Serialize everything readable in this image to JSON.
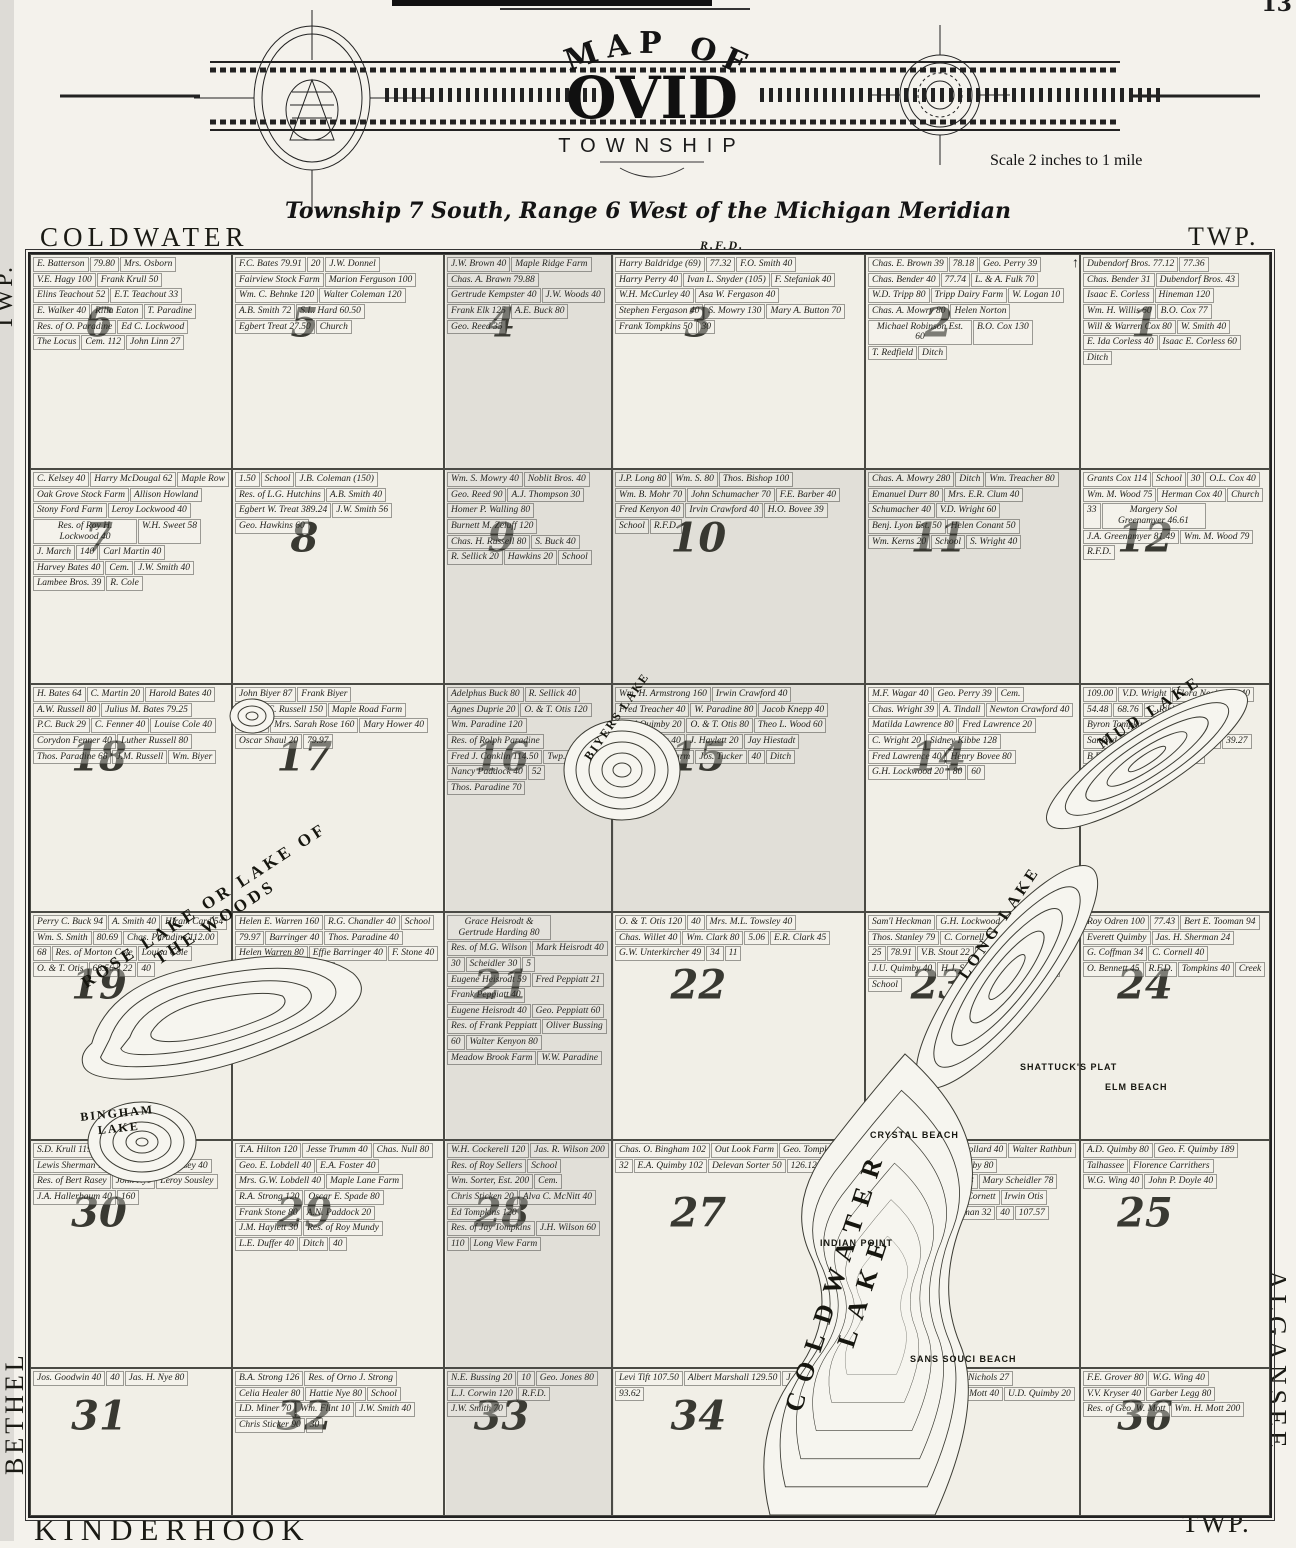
{
  "page": {
    "number": "13"
  },
  "header": {
    "map_of": "MAP OF",
    "name": "OVID",
    "township": "TOWNSHIP",
    "scale": "Scale 2 inches to 1 mile",
    "subtitle": "Township 7 South, Range 6 West of the Michigan Meridian"
  },
  "borders": {
    "top_left": "COLDWATER",
    "top_center": "R.F.D.",
    "top_right": "TWP.",
    "left_top": "TWP.",
    "left_bottom": "BETHEL",
    "bottom_left": "KINDERHOOK",
    "bottom_right": "TWP.",
    "right_top": "TWP.",
    "right_bottom": "ALGANSEE",
    "north_arrow": "↑"
  },
  "map": {
    "lakes": [
      "BIYERS LAKE",
      "MUD LAKE",
      "ROSE LAKE OR LAKE OF THE WOODS",
      "BINGHAM LAKE",
      "LONG LAKE",
      "COLDWATER LAKE"
    ],
    "features": [
      "SHATTUCK'S PLAT",
      "ELM BEACH",
      "CRYSTAL BEACH",
      "INDIAN POINT",
      "SANS SOUCI BEACH"
    ],
    "sections": [
      {
        "number": "6",
        "parcels": [
          "E. Batterson",
          "79.80",
          "Mrs. Osborn",
          "V.E. Hagy 100",
          "Frank Krull 50",
          "Elins Teachout 52",
          "E.T. Teachout 33",
          "E. Walker 40",
          "Rilla Eaton",
          "T. Paradine",
          "Res. of O. Paradine",
          "Ed C. Lockwood",
          "The Locus",
          "Cem. 112",
          "John Linn 27"
        ]
      },
      {
        "number": "5",
        "parcels": [
          "F.C. Bates 79.91",
          "20",
          "J.W. Donnel",
          "Fairview Stock Farm",
          "Marion Ferguson 100",
          "Wm. C. Behnke 120",
          "Walter Coleman 120",
          "A.B. Smith 72",
          "S.L. Hard 60.50",
          "Egbert Treat 27.50",
          "Church"
        ]
      },
      {
        "number": "4",
        "parcels": [
          "J.W. Brown 40",
          "Maple Ridge Farm",
          "Chas. A. Brawn 79.88",
          "Gertrude Kempster 40",
          "J.W. Woods 40",
          "Frank Elk 125",
          "A.E. Buck 80",
          "Geo. Reed 35"
        ]
      },
      {
        "number": "3",
        "parcels": [
          "Harry Baldridge (69)",
          "77.32",
          "F.O. Smith 40",
          "Harry Perry 40",
          "Ivan L. Snyder (105)",
          "F. Stefaniak 40",
          "W.H. McCurley 40",
          "Asa W. Fergason 40",
          "Stephen Fergason 40",
          "S. Mowry 130",
          "Mary A. Button 70",
          "Frank Tompkins 50",
          "30"
        ]
      },
      {
        "number": "2",
        "parcels": [
          "Chas. E. Brown 39",
          "78.18",
          "Geo. Perry 39",
          "Chas. Bender 40",
          "77.74",
          "L. & A. Fulk 70",
          "W.D. Tripp 80",
          "Tripp Dairy Farm",
          "W. Logan 10",
          "Chas. A. Mowry 80",
          "Helen Norton",
          "Michael Robinson Est. 60",
          "B.O. Cox 130",
          "T. Redfield",
          "Ditch"
        ]
      },
      {
        "number": "1",
        "parcels": [
          "Dubendorf Bros. 77.12",
          "77.36",
          "Chas. Bender 31",
          "Dubendorf Bros. 43",
          "Isaac E. Corless",
          "Hineman 120",
          "Wm. H. Willis 60",
          "B.O. Cox 77",
          "Will & Warren Cox 80",
          "W. Smith 40",
          "E. Ida Corless 40",
          "Isaac E. Corless 60",
          "Ditch"
        ]
      },
      {
        "number": "7",
        "parcels": [
          "C. Kelsey 40",
          "Harry McDougal 62",
          "Maple Row",
          "Oak Grove Stock Farm",
          "Allison Howland",
          "Stony Ford Farm",
          "Leroy Lockwood 40",
          "Res. of Roy H. Lockwood 40",
          "W.H. Sweet 58",
          "J. March",
          "140",
          "Carl Martin 40",
          "Harvey Bates 40",
          "Cem.",
          "J.W. Smith 40",
          "Lambee Bros. 39",
          "R. Cole"
        ]
      },
      {
        "number": "8",
        "parcels": [
          "1.50",
          "School",
          "J.B. Coleman (150)",
          "Res. of L.G. Hutchins",
          "A.B. Smith 40",
          "Egbert W. Treat 389.24",
          "J.W. Smith 56",
          "Geo. Hawkins 60"
        ]
      },
      {
        "number": "9",
        "parcels": [
          "Wm. S. Mowry 40",
          "Noblit Bros. 40",
          "Geo. Reed 90",
          "A.J. Thompson 30",
          "Homer P. Walling 80",
          "Burnett M. Zeluff 120",
          "Chas. H. Russell 80",
          "S. Buck 40",
          "R. Sellick 20",
          "Hawkins 20",
          "School"
        ]
      },
      {
        "number": "10",
        "shaded": true,
        "parcels": [
          "J.P. Long 80",
          "Wm. S. 80",
          "Thos. Bishop 100",
          "Wm. B. Mohr 70",
          "John Schumacher 70",
          "F.E. Barber 40",
          "Fred Kenyon 40",
          "Irvin Crawford 40",
          "H.O. Bovee 39",
          "School",
          "R.F.D."
        ]
      },
      {
        "number": "11",
        "shaded": true,
        "parcels": [
          "Chas. A. Mowry 280",
          "Ditch",
          "Wm. Treacher 80",
          "Emanuel Durr 80",
          "Mrs. E.R. Clum 40",
          "Schumacher 40",
          "V.D. Wright 60",
          "Benj. Lyon Est. 50",
          "Helen Conant 50",
          "Wm. Kerns 20",
          "School",
          "S. Wright 40"
        ]
      },
      {
        "number": "12",
        "parcels": [
          "Grants Cox 114",
          "School",
          "30",
          "O.L. Cox 40",
          "Wm. M. Wood 75",
          "Herman Cox 40",
          "Church",
          "33",
          "Margery Sol Greenamyer 46.61",
          "J.A. Greenamyer 81.49",
          "Wm. M. Wood 79",
          "R.F.D."
        ]
      },
      {
        "number": "18",
        "parcels": [
          "H. Bates 64",
          "C. Martin 20",
          "Harold Bates 40",
          "A.W. Russell 80",
          "Julius M. Bates 79.25",
          "P.C. Buck 29",
          "C. Fenner 40",
          "Louise Cole 40",
          "Corydon Fenner 40",
          "Luther Russell 80",
          "Thos. Paradine 68",
          "J.M. Russell",
          "Wm. Biyer"
        ]
      },
      {
        "number": "17",
        "parcels": [
          "John Biyer 87",
          "Frank Biyer",
          "Nelson C. Russell 150",
          "Maple Road Farm",
          "136.67",
          "Mrs. Sarah Rose 160",
          "Mary Hower 40",
          "Oscar Shaul 20",
          "79.97"
        ]
      },
      {
        "number": "16",
        "parcels": [
          "Adelphus Buck 80",
          "R. Sellick 40",
          "Agnes Duprie 20",
          "O. & T. Otis 120",
          "Wm. Paradine 120",
          "Res. of Rolph Paradine",
          "Fred J. Conklin 114.50",
          "Twp. Hall",
          "Nancy Paddock 40",
          "52",
          "Thos. Paradine 70"
        ]
      },
      {
        "number": "15",
        "shaded": true,
        "parcels": [
          "Wm. H. Armstrong 160",
          "Irwin Crawford 40",
          "Fred Treacher 40",
          "W. Paradine 80",
          "Jacob Knepp 40",
          "Fred Quimby 20",
          "O. & T. Otis 80",
          "Theo L. Wood 60",
          "Emma Noyes 40",
          "J. Haylett 20",
          "Jay Hiestadt",
          "Maple Knoll Farm",
          "Jos. Tucker",
          "40",
          "Ditch"
        ]
      },
      {
        "number": "14",
        "parcels": [
          "M.F. Wagar 40",
          "Geo. Perry 39",
          "Cem.",
          "Chas. Wright 39",
          "A. Tindall",
          "Newton Crawford 40",
          "Matilda Lawrence 80",
          "Fred Lawrence 20",
          "C. Wright 20",
          "Sidney Kibbe 128",
          "Fred Lawrence 40",
          "Henry Bovee 80",
          "G.H. Lockwood 20",
          "80",
          "60"
        ]
      },
      {
        "number": "13",
        "parcels": [
          "109.00",
          "V.D. Wright",
          "Flora Neairpass 40",
          "54.48",
          "68.76",
          "C. Ribbeck 109",
          "Byron Tompkins 40",
          "A. Tindall 70",
          "Sanford Tompkins 40",
          "M. Tarr 40",
          "39.27",
          "B.E. Tooman 40",
          "Waldron 10",
          "Addison Tompkins"
        ]
      },
      {
        "number": "19",
        "parcels": [
          "Perry C. Buck 94",
          "A. Smith 40",
          "Hiram Card 54",
          "Wm. S. Smith",
          "80.69",
          "Chas. Paradine 112.00",
          "68",
          "Res. of Morton Cole",
          "Louisa Cole",
          "O. & T. Otis",
          "68.56",
          "22",
          "40"
        ]
      },
      {
        "number": "20",
        "parcels": [
          "Helen E. Warren 160",
          "R.G. Chandler 40",
          "School",
          "79.97",
          "Barringer 40",
          "Thos. Paradine 40",
          "Helen Warren 80",
          "Effie Barringer 40",
          "F. Stone 40",
          "L.E. Duffer 80",
          "40",
          "80"
        ]
      },
      {
        "number": "21",
        "parcels": [
          "Grace Heisrodt & Gertrude Harding 80",
          "Res. of M.G. Wilson",
          "Mark Heisrodt 40",
          "30",
          "Scheidler 30",
          "5",
          "Eugene Heisrodt 59",
          "Fred Peppiatt 21",
          "Frank Peppiatt 40",
          "Eugene Heisrodt 40",
          "Geo. Peppiatt 60",
          "Res. of Frank Peppiatt",
          "Oliver Bussing",
          "60",
          "Walter Kenyon 80",
          "Meadow Brook Farm",
          "W.W. Paradine"
        ]
      },
      {
        "number": "22",
        "parcels": [
          "O. & T. Otis 120",
          "40",
          "Mrs. M.L. Towsley 40",
          "Chas. Willet 40",
          "Wm. Clark 80",
          "5.06",
          "E.R. Clark 45",
          "G.W. Unterkircher 49",
          "34",
          "11"
        ]
      },
      {
        "number": "23",
        "parcels": [
          "Sam'l Heckman",
          "G.H. Lockwood 16",
          "97.86",
          "Thos. Stanley 79",
          "C. Cornell 16",
          "F.G. Pond 50",
          "25",
          "78.91",
          "V.B. Stout 22",
          "Jud. Quimby",
          "J.U. Quimby 40",
          "H.J. Sorter 40",
          "Locas Hill 37",
          "School"
        ]
      },
      {
        "number": "24",
        "parcels": [
          "Roy Odren 100",
          "77.43",
          "Bert E. Tooman 94",
          "Everett Quimby",
          "Jas. H. Sherman 24",
          "G. Coffman 34",
          "C. Cornell 40",
          "O. Bennett 45",
          "R.F.D.",
          "Tompkins 40",
          "Creek"
        ]
      },
      {
        "number": "30",
        "parcels": [
          "S.D. Krull 119.41",
          "T.A. Hilton",
          "Lewis Sherman 101",
          "R.F.D.",
          "Bert Rasey 40",
          "Res. of Bert Rasey",
          "John Nye",
          "Leroy Sousley",
          "J.A. Hallerbaum 40",
          "160"
        ]
      },
      {
        "number": "29",
        "parcels": [
          "T.A. Hilton 120",
          "Jesse Trumm 40",
          "Chas. Null 80",
          "Geo. E. Lobdell 40",
          "E.A. Foster 40",
          "Mrs. G.W. Lobdell 40",
          "Maple Lane Farm",
          "R.A. Strong 120",
          "Oscar E. Spade 80",
          "Frank Stone 80",
          "A.N. Paddock 20",
          "J.M. Haylett 30",
          "Res. of Roy Mundy",
          "L.E. Duffer 40",
          "Ditch",
          "40"
        ]
      },
      {
        "number": "28",
        "parcels": [
          "W.H. Cockerell 120",
          "Jas. R. Wilson 200",
          "Res. of Roy Sellers",
          "School",
          "Wm. Sorter, Est. 200",
          "Cem.",
          "Chris Sticken 20",
          "Alva C. McNitt 40",
          "Ed Tompkins 120",
          "Res. of Jay Tompkins",
          "J.H. Wilson 60",
          "110",
          "Long View Farm"
        ]
      },
      {
        "number": "27",
        "parcels": [
          "Chas. O. Bingham 102",
          "Out Look Farm",
          "Geo. Tompkins 95",
          "32",
          "E.A. Quimby 102",
          "Delevan Sorter 50",
          "126.12",
          "110.00"
        ]
      },
      {
        "number": "26",
        "parcels": [
          "E.W. Quimby 40",
          "O.L. Collard 40",
          "Walter Rathbun",
          "Fertile Farm",
          "W.H. Quimby 80",
          "Frank Muddle 100",
          "15.23",
          "Mary Scheidler 78",
          "Henry Echtinaw 40",
          "D. Cornett",
          "Irwin Otis",
          "W.G. Wing",
          "Clark Sherman 32",
          "40",
          "107.57"
        ]
      },
      {
        "number": "25",
        "parcels": [
          "A.D. Quimby 80",
          "Geo. F. Quimby 189",
          "Talhassee",
          "Florence Carrithers",
          "W.G. Wing 40",
          "John P. Doyle 40"
        ]
      },
      {
        "number": "31",
        "parcels": [
          "Jos. Goodwin 40",
          "40",
          "Jas. H. Nye 80"
        ]
      },
      {
        "number": "32",
        "parcels": [
          "B.A. Strong 126",
          "Res. of Orno J. Strong",
          "Celia Healer 80",
          "Hattie Nye 80",
          "School",
          "I.D. Miner 70",
          "Wm. Flint 10",
          "J.W. Smith 40",
          "Chris Sticker 90",
          "30"
        ]
      },
      {
        "number": "33",
        "parcels": [
          "N.E. Bussing 20",
          "10",
          "Geo. Jones 80",
          "L.J. Corwin 120",
          "R.F.D.",
          "J.W. Smith 70"
        ]
      },
      {
        "number": "34",
        "parcels": [
          "Levi Tift 107.50",
          "Albert Marshall 129.50",
          "J. Echtinaw",
          "93.62"
        ]
      },
      {
        "number": "35",
        "parcels": [
          "John Echtinaw 75",
          "O.F. Nichols 27",
          "Dora E. Myers 40",
          "Wm. Mott 40",
          "U.D. Quimby 20",
          "T.E. Thompson 20"
        ]
      },
      {
        "number": "36",
        "parcels": [
          "F.E. Grover 80",
          "W.G. Wing 40",
          "V.V. Kryser 40",
          "Garber Legg 80",
          "Res. of Geo. W. Mott",
          "Wm. H. Mott 200"
        ]
      }
    ]
  }
}
